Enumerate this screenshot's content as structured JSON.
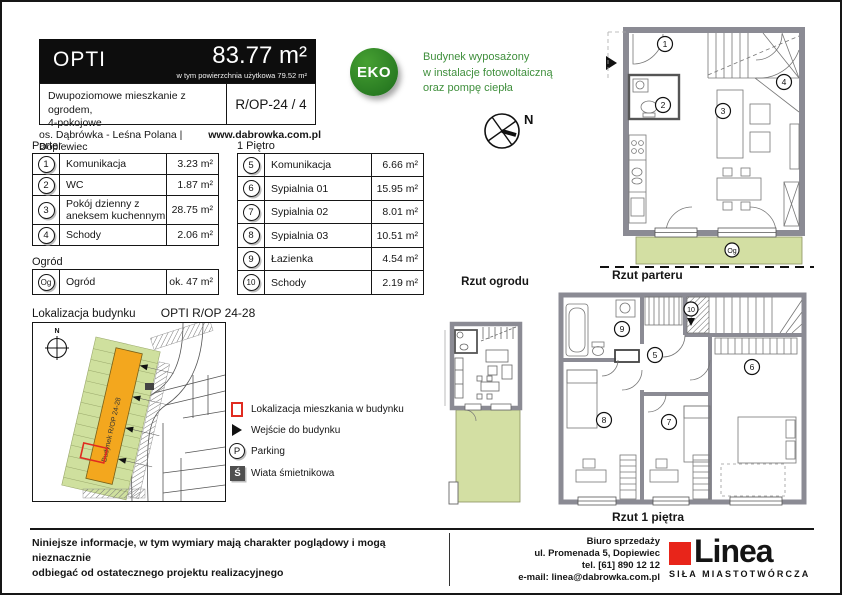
{
  "colors": {
    "accent_green": "#2c7e28",
    "text_green": "#3f8f3c",
    "garden_green": "#d3dfa3",
    "map_green": "#cfe09e",
    "building_orange": "#f3a71e",
    "brand_red": "#e8251a",
    "marker_red": "#e02b20",
    "wall_gray": "#8b8b94"
  },
  "header": {
    "title": "OPTI",
    "area": "83.77 m²",
    "area_note": "w tym powierzchnia użytkowa 79.52 m²",
    "description_line1": "Dwupoziomowe mieszkanie z ogrodem,",
    "description_line2": "4-pokojowe",
    "unit_code": "R/OP-24 / 4",
    "estate": "os. Dąbrówka - Leśna Polana | Dopiewiec",
    "website": "www.dabrowka.com.pl"
  },
  "eco": {
    "badge": "EKO",
    "line1": "Budynek wyposażony",
    "line2": "w instalacje fotowoltaiczną",
    "line3": "oraz pompę ciepła"
  },
  "compass": {
    "label": "N"
  },
  "tables": {
    "parter": {
      "title": "Parter",
      "rows": [
        {
          "num": "1",
          "name": "Komunikacja",
          "area": "3.23 m²"
        },
        {
          "num": "2",
          "name": "WC",
          "area": "1.87 m²"
        },
        {
          "num": "3",
          "name": "Pokój dzienny z aneksem kuchennym",
          "area": "28.75 m²"
        },
        {
          "num": "4",
          "name": "Schody",
          "area": "2.06 m²"
        }
      ]
    },
    "ogrod": {
      "title": "Ogród",
      "rows": [
        {
          "num": "Og",
          "name": "Ogród",
          "area": "ok. 47 m²"
        }
      ]
    },
    "pietro": {
      "title": "1 Piętro",
      "rows": [
        {
          "num": "5",
          "name": "Komunikacja",
          "area": "6.66 m²"
        },
        {
          "num": "6",
          "name": "Sypialnia 01",
          "area": "15.95 m²"
        },
        {
          "num": "7",
          "name": "Sypialnia 02",
          "area": "8.01 m²"
        },
        {
          "num": "8",
          "name": "Sypialnia 03",
          "area": "10.51 m²"
        },
        {
          "num": "9",
          "name": "Łazienka",
          "area": "4.54 m²"
        },
        {
          "num": "10",
          "name": "Schody",
          "area": "2.19 m²"
        }
      ]
    }
  },
  "site_map": {
    "title": "Lokalizacja budynku",
    "subtitle": "OPTI R/OP 24-28",
    "building_label": "Budynek R/OP 24-28",
    "compass_label": "N"
  },
  "legend": {
    "apartment": "Lokalizacja mieszkania w budynku",
    "entrance": "Wejście do budynku",
    "parking": "Parking",
    "parking_symbol": "P",
    "shed": "Wiata śmietnikowa",
    "shed_symbol": "Ś"
  },
  "plans": {
    "garden": {
      "caption": "Rzut ogrodu"
    },
    "ground": {
      "caption": "Rzut parteru",
      "n1": "1",
      "n2": "2",
      "n3": "3",
      "n4": "4",
      "ng": "Og"
    },
    "first": {
      "caption": "Rzut 1 piętra",
      "n5": "5",
      "n6": "6",
      "n7": "7",
      "n8": "8",
      "n9": "9",
      "n10": "10"
    }
  },
  "footer": {
    "disclaimer_line1": "Niniejsze informacje, w tym wymiary mają charakter poglądowy i mogą nieznacznie",
    "disclaimer_line2": "odbiegać od ostatecznego projektu realizacyjnego",
    "office_line1": "Biuro sprzedaży",
    "office_line2": "ul. Promenada 5, Dopiewiec",
    "office_line3": "tel. [61] 890 12 12",
    "office_line4": "e-mail: linea@dabrowka.com.pl",
    "brand": "Linea",
    "brand_tagline": "SIŁA MIASTOTWÓRCZA"
  }
}
